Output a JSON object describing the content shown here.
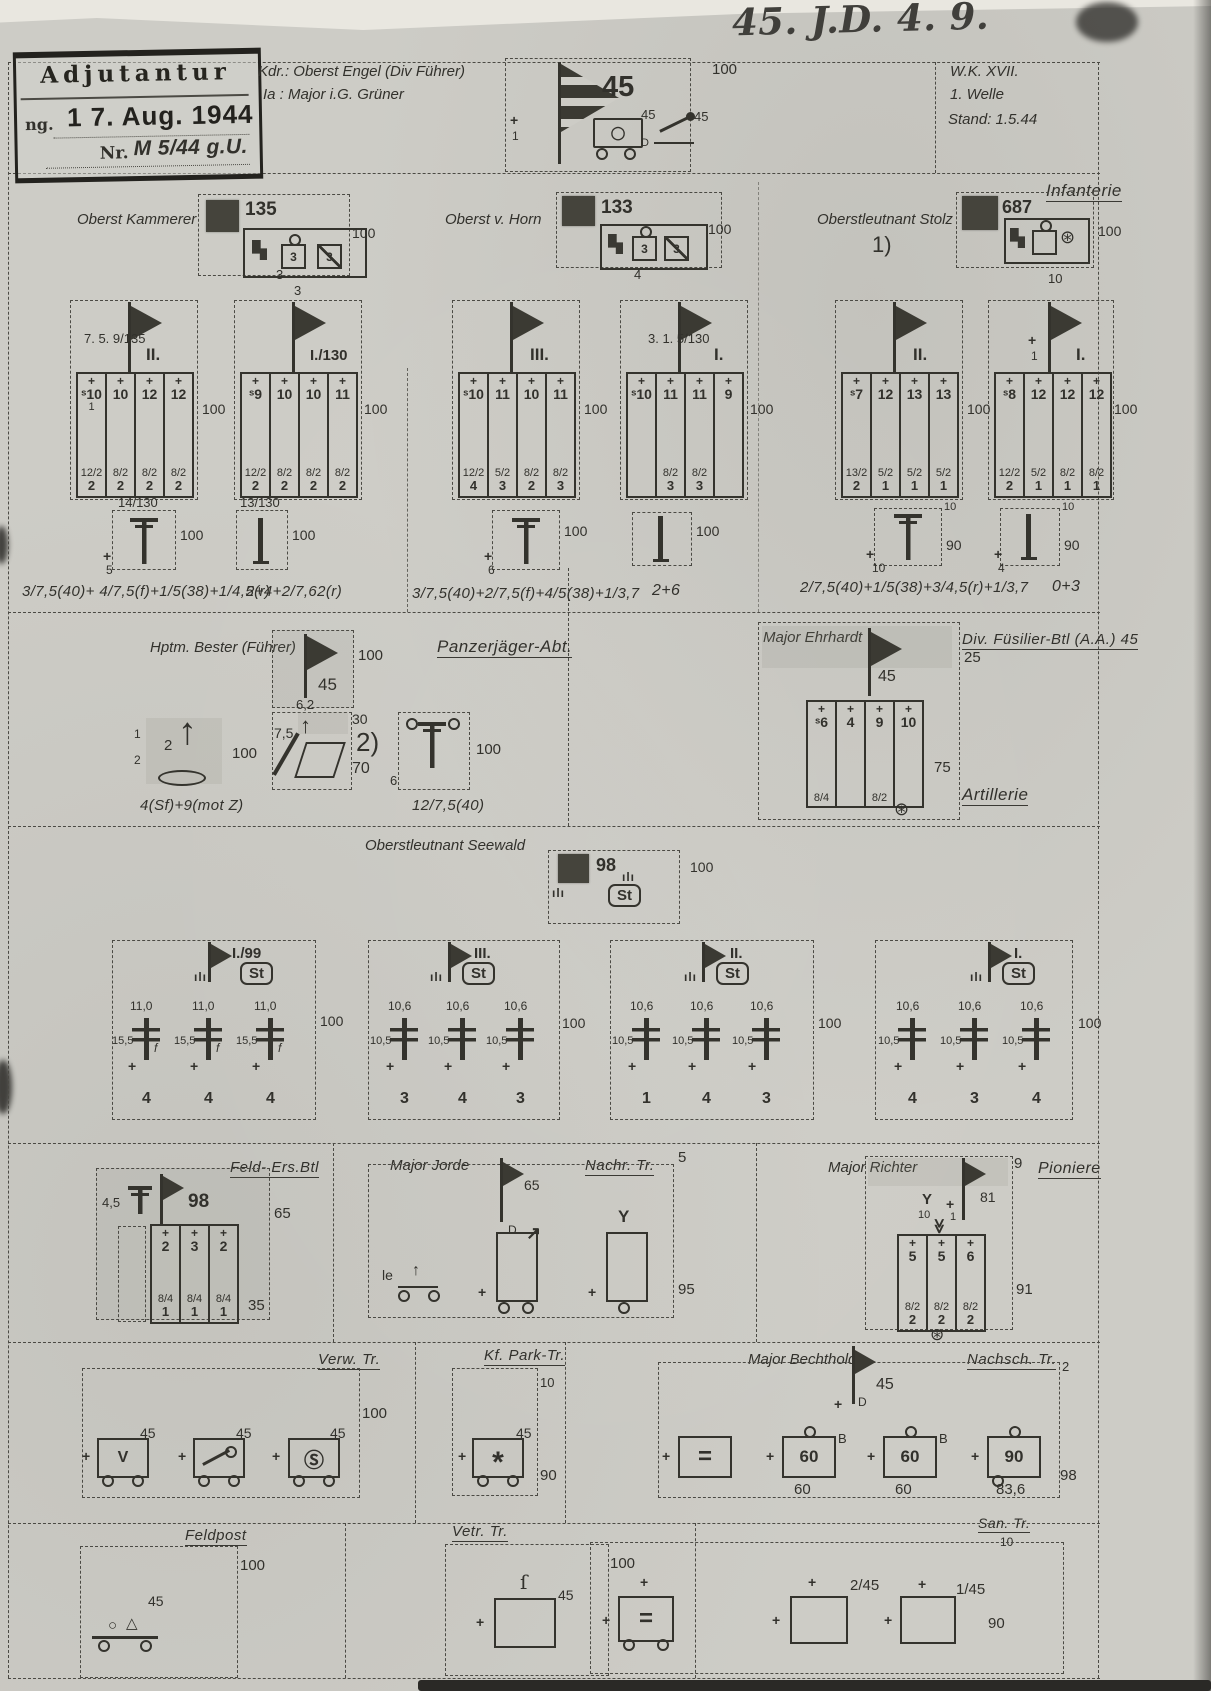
{
  "scan": {
    "handwriting_top": "45. J.D.  4. 9.",
    "stamp": {
      "title": "Adjutantur",
      "date_prefix": "ng.",
      "date": "1 7. Aug. 1944",
      "nr_prefix": "Nr.",
      "nr_value": "M 5/44 g.U."
    },
    "command": {
      "kdr": "Kdr.: Oberst Engel (Div Führer)",
      "ia": "Ia :  Major i.G. Grüner"
    },
    "corner": {
      "wk": "W.K.  XVII.",
      "welle": "1. Welle",
      "stand": "Stand: 1.5.44"
    }
  },
  "division": {
    "flag_number": "45",
    "strength": "100",
    "left_note": "1",
    "truck_number": "45",
    "truck_sub": "D",
    "car_number": "45"
  },
  "infanterie": {
    "title": "Infanterie",
    "regiments": [
      {
        "commander": "Oberst Kammerer",
        "flag_number": "135",
        "strength": "100",
        "below_note": "3",
        "cells": [
          "3",
          "3"
        ],
        "battalions": [
          {
            "title": "II.",
            "sup_label": "7.  5.  9/135",
            "mid_note": "1",
            "tops": [
              "ˢ10",
              "10",
              "12",
              "12"
            ],
            "fracs": [
              "12/2",
              "8/2",
              "8/2",
              "8/2"
            ],
            "bottoms": [
              "2",
              "2",
              "2",
              "2"
            ],
            "strength": "100"
          },
          {
            "title": "I./130",
            "top_note": "3",
            "tops": [
              "ˢ9",
              "10",
              "10",
              "11"
            ],
            "fracs": [
              "12/2",
              "8/2",
              "8/2",
              "8/2"
            ],
            "bottoms": [
              "2",
              "2",
              "2",
              "2"
            ],
            "strength": "100"
          }
        ],
        "supports": [
          {
            "label": "14/130",
            "strength": "100",
            "bl": "5",
            "tr": ""
          },
          {
            "label": "13/130",
            "strength": "100",
            "bl": "",
            "tr": ""
          }
        ],
        "ann1": "3/7,5(40)+ 4/7,5(f)+1/5(38)+1/4,5(r)",
        "ann2": "2+4+2/7,62(r)"
      },
      {
        "commander": "Oberst  v. Horn",
        "flag_number": "133",
        "strength": "100",
        "below_note": "4",
        "cells": [
          "3",
          "3"
        ],
        "battalions": [
          {
            "title": "III.",
            "tops": [
              "ˢ10",
              "11",
              "10",
              "11"
            ],
            "fracs": [
              "12/2",
              "5/2",
              "8/2",
              "8/2"
            ],
            "bottoms": [
              "4",
              "3",
              "2",
              "3"
            ],
            "strength": "100"
          },
          {
            "title": "I.",
            "sup_label": "3.  1.  5/130",
            "tops": [
              "ˢ10",
              "11",
              "11",
              "9"
            ],
            "fracs": [
              "",
              "8/2",
              "8/2",
              ""
            ],
            "bottoms": [
              "",
              "3",
              "3",
              ""
            ],
            "strength": "100"
          }
        ],
        "supports": [
          {
            "label": "",
            "strength": "100",
            "bl": "6",
            "tr": ""
          },
          {
            "label": "",
            "strength": "100",
            "bl": "",
            "tr": ""
          }
        ],
        "ann1": "3/7,5(40)+2/7,5(f)+4/5(38)+1/3,7",
        "ann2": "2+6"
      },
      {
        "commander": "Oberstleutnant Stolz",
        "footnote": "1)",
        "flag_number": "687",
        "strength": "100",
        "below_note": "10",
        "cells": [
          "",
          ""
        ],
        "battalions": [
          {
            "title": "II.",
            "tops": [
              "ˢ7",
              "12",
              "13",
              "13"
            ],
            "fracs": [
              "13/2",
              "5/2",
              "5/2",
              "5/2"
            ],
            "bottoms": [
              "2",
              "1",
              "1",
              "1"
            ],
            "strength": "100"
          },
          {
            "title": "I.",
            "top_note": "1",
            "tops": [
              "ˢ8",
              "12",
              "12",
              "12"
            ],
            "fracs": [
              "12/2",
              "5/2",
              "8/2",
              "8/2"
            ],
            "bottoms": [
              "2",
              "1",
              "1",
              "1"
            ],
            "strength": "100"
          }
        ],
        "supports": [
          {
            "label": "",
            "strength": "90",
            "bl": "10",
            "tr": "10"
          },
          {
            "label": "",
            "strength": "90",
            "bl": "4",
            "tr": "10"
          }
        ],
        "ann1": "2/7,5(40)+1/5(38)+3/4,5(r)+1/3,7",
        "ann2": "0+3"
      }
    ]
  },
  "panzerjaeger": {
    "commander": "Hptm. Bester (Führer)",
    "title": "Panzerjäger-Abt.",
    "flag_number": "45",
    "flag_strength": "100",
    "unit1": {
      "num": "2",
      "l1": "1",
      "l2": "2",
      "strength": "100",
      "ann": "4(Sf)+9(mot Z)"
    },
    "unit2": {
      "top": "6,2",
      "left": "7,5",
      "rt": "30",
      "footnote": "2)",
      "rb": "70"
    },
    "unit3": {
      "left": "6",
      "strength": "100",
      "ann": "12/7,5(40)"
    }
  },
  "fuesilier": {
    "commander": "Major Ehrhardt",
    "title": "Div. Füsilier-Btl (A.A.) 45",
    "flag_number": "45",
    "flag_strength": "25",
    "strength": "75",
    "tops": [
      "ˢ6",
      "4",
      "9",
      "10"
    ],
    "fracs": [
      "8/4",
      "",
      "8/2",
      ""
    ],
    "bottoms": [
      "",
      "",
      "",
      ""
    ]
  },
  "artillerie": {
    "commander": "Oberstleutnant Seewald",
    "title": "Artillerie",
    "flag_number": "98",
    "strength": "100",
    "st": "St",
    "groups": [
      {
        "title": "I./99",
        "st": "St",
        "strength": "100",
        "cal": [
          "11,0",
          "11,0",
          "11,0"
        ],
        "sub": [
          "15,5",
          "15,5",
          "15,5"
        ],
        "f": "f",
        "counts": [
          "4",
          "4",
          "4"
        ]
      },
      {
        "title": "III.",
        "st": "St",
        "strength": "100",
        "cal": [
          "10,6",
          "10,6",
          "10,6"
        ],
        "sub": [
          "10,5",
          "10,5",
          "10,5"
        ],
        "f": "",
        "counts": [
          "3",
          "4",
          "3"
        ]
      },
      {
        "title": "II.",
        "st": "St",
        "strength": "100",
        "cal": [
          "10,6",
          "10,6",
          "10,6"
        ],
        "sub": [
          "10,5",
          "10,5",
          "10,5"
        ],
        "f": "",
        "counts": [
          "1",
          "4",
          "3"
        ]
      },
      {
        "title": "I.",
        "st": "St",
        "strength": "100",
        "cal": [
          "10,6",
          "10,6",
          "10,6"
        ],
        "sub": [
          "10,5",
          "10,5",
          "10,5"
        ],
        "f": "",
        "counts": [
          "4",
          "3",
          "4"
        ]
      }
    ]
  },
  "feld_ers": {
    "title": "Feld- Ers.Btl",
    "flag_number": "98",
    "left_cal": "4,5",
    "strength": "65",
    "strength2": "35",
    "tops": [
      "2",
      "3",
      "2"
    ],
    "fracs": [
      "8/4",
      "8/4",
      "8/4"
    ],
    "bottoms": [
      "1",
      "1",
      "1"
    ]
  },
  "nachrichten": {
    "commander": "Major Jorde",
    "title": "Nachr. Tr.",
    "corner": "5",
    "flag_number": "65",
    "flag_sub": "D",
    "le_label": "le",
    "strength": "95"
  },
  "pioniere": {
    "commander": "Major Richter",
    "title": "Pioniere",
    "corner": "9",
    "flag_number": "81",
    "n1": "10",
    "n2": "1",
    "tops": [
      "5",
      "5",
      "6"
    ],
    "fracs": [
      "8/2",
      "8/2",
      "8/2"
    ],
    "bottoms": [
      "2",
      "2",
      "2"
    ],
    "strength": "91"
  },
  "verwaltung": {
    "title": "Verw. Tr.",
    "strength": "100",
    "w1_glyph": "V",
    "w1_num": "45",
    "w2_num": "45",
    "w3_glyph": "Ⓢ",
    "w3_num": "45"
  },
  "kf_park": {
    "title": "Kf. Park-Tr.",
    "top": "10",
    "glyph": "*",
    "num": "45",
    "strength": "90"
  },
  "nachschub": {
    "commander": "Major Bechthold",
    "title": "Nachsch. Tr.",
    "corner": "2",
    "flag_number": "45",
    "flag_sub": "D",
    "u1_glyph": "=",
    "u2_label": "60",
    "u2_sup": "B",
    "u2_below": "60",
    "u3_label": "60",
    "u3_sup": "B",
    "u3_below": "60",
    "u4_label": "90",
    "u4_below": "83,6",
    "strength": "98"
  },
  "feldpost": {
    "title": "Feldpost",
    "strength": "100",
    "num": "45"
  },
  "veterinaer": {
    "title": "Vetr. Tr.",
    "strength": "100",
    "num": "45"
  },
  "sanitaet": {
    "title": "San. Tr.",
    "sub": "10",
    "u1_glyph": "=",
    "u2_label": "2/45",
    "u3_label": "1/45",
    "strength": "90"
  },
  "icons": {
    "cross-icon": "+",
    "pennant-icon": "right-triangle-flag",
    "infantry-gun-icon": "T-bar",
    "column-icon": "vertical-bar",
    "artillery-gun-icon": "barred-post",
    "wagon-icon": "box-with-wheels",
    "wheel-icon": "⊛",
    "radio-arrow-icon": "↗",
    "phone-fork-icon": "Y",
    "hook-icon": "ſ",
    "chevrons-icon": "≪",
    "staff-marks-icon": "ılı",
    "sun-icon": "*"
  }
}
